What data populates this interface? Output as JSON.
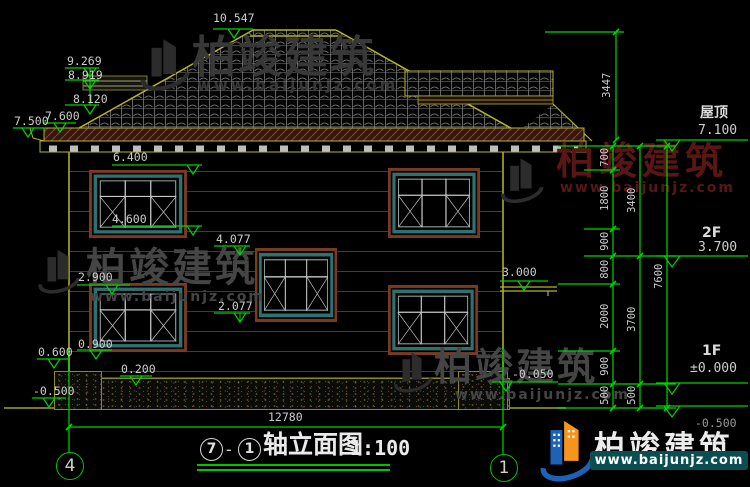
{
  "watermark": {
    "brand": "柏竣建筑",
    "url": "www.baijunjz.com"
  },
  "title": {
    "axis_from": "7",
    "dash": "-",
    "axis_to": "1",
    "text": "轴立面图",
    "scale": "1:100"
  },
  "axis_bubbles": {
    "left": "4",
    "right": "1"
  },
  "floors": {
    "roof_label": "屋顶",
    "roof_value": "7.100",
    "f2_label": "2F",
    "f2_value": "3.700",
    "f1_label": "1F",
    "f1_value": "±0.000",
    "below_grade": "-0.500"
  },
  "levels": {
    "v10547": "10.547",
    "v9269": "9.269",
    "v8919": "8.919",
    "v8120": "8.120",
    "v7600": "7.600",
    "v7500": "7.500",
    "v6400": "6.400",
    "v4600": "4.600",
    "v4077": "4.077",
    "v2900": "2.900",
    "v2077": "2.077",
    "v0900": "0.900",
    "v0600": "0.600",
    "v0200": "0.200",
    "vm0500": "-0.500",
    "v3000": "3.000",
    "vm0050": "-0.050"
  },
  "dims": {
    "d3447": "3447",
    "d700": "700",
    "d1800": "1800",
    "d900a": "900",
    "d800": "800",
    "d2000": "2000",
    "d900b": "900",
    "d500a": "500",
    "d3400": "3400",
    "d3700": "3700",
    "d500b": "500",
    "d7600": "7600",
    "d12780": "12780"
  },
  "colors": {
    "dim_green": "#00d400",
    "text_gray": "#cdcdcd",
    "roof_outline": "#b5b52a",
    "wall_outline": "#8a8a20",
    "window_teal": "#2f7070",
    "window_trim": "#7a3a22",
    "watermark_gray": "#454545",
    "watermark_red": "#5a1515",
    "logo_orange": "#f7941d",
    "logo_blue": "#1c63b7",
    "url_box_teal": "#0b4e52"
  }
}
